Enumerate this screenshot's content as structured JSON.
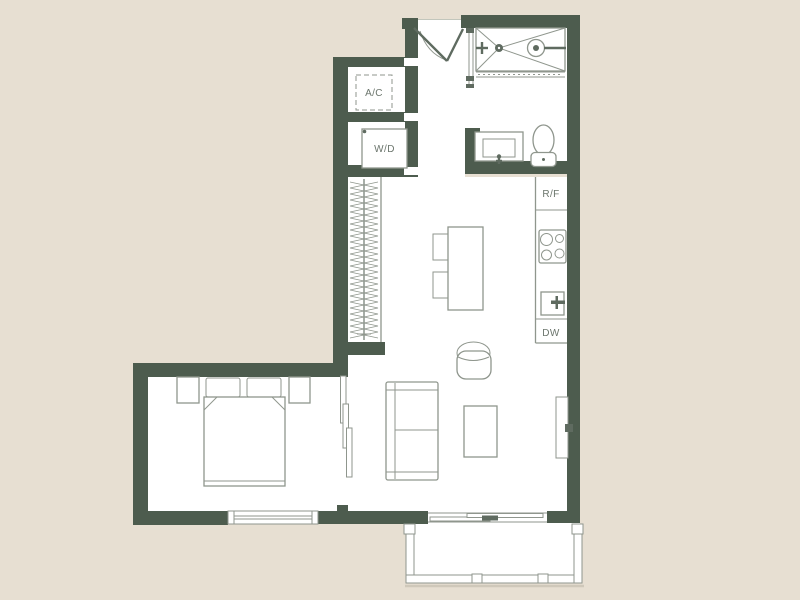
{
  "plan": {
    "labels": {
      "ac": "A/C",
      "wd": "W/D",
      "rf": "R/F",
      "dw": "DW"
    }
  },
  "colors": {
    "background": "#e7dfd2",
    "floor": "#ffffff",
    "wall": "#4d5c4e",
    "line": "#8f968d",
    "line_dark": "#5f6b60",
    "label": "#6b756c",
    "shadow": "#cfc8ba"
  }
}
